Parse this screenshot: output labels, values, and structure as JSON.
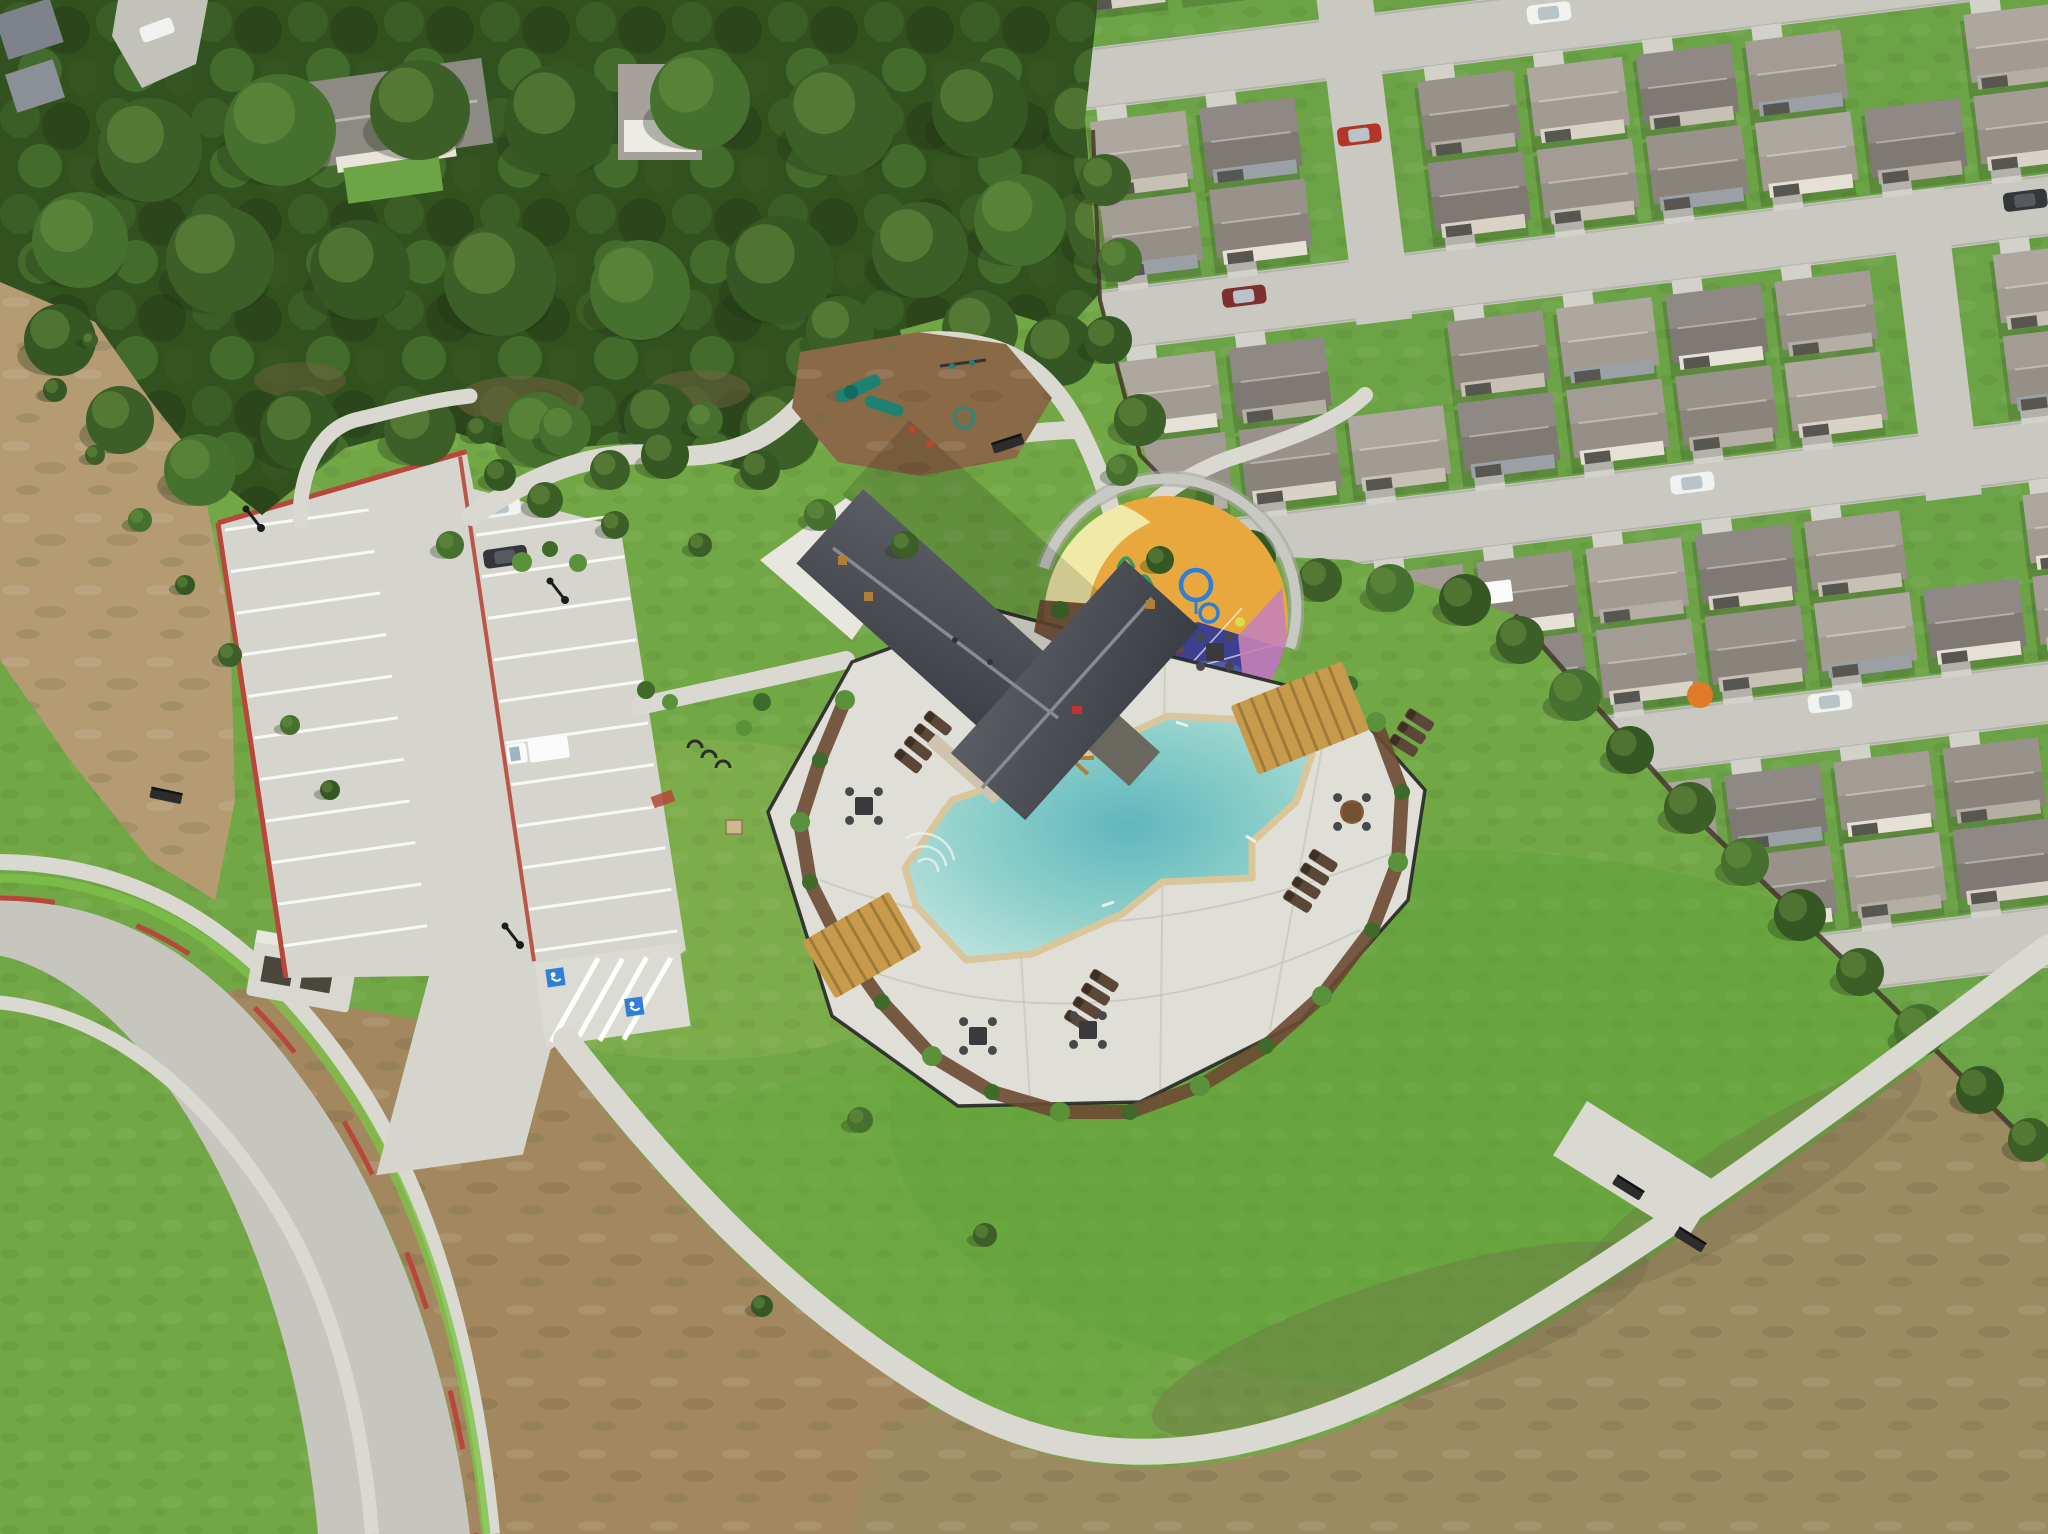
{
  "scene": {
    "description": "Aerial drone photo of a new residential community amenity center: cross-gabled clubhouse, angular swimming pool with white deck and black fence, colorful circular splash pad, playground in pine forest, parking lot with red curbs, winding sidewalks, suburban rooftops upper right, bare dirt lots lower left and lower right",
    "colors": {
      "lawn": "#72a746",
      "lawn_bright": "#5da335",
      "lawn_shadow": "#4e8a2f",
      "forest_base": "#31511f",
      "tree_shadow": "#1d3314",
      "tree_light": "#6f9a44",
      "dirt_left": "#b49b72",
      "dirt_bottom": "#a3885f",
      "dirt_slope": "#9c8a60",
      "dirt_streak": "#6f6b49",
      "concrete": "#d6d5cd",
      "concrete_bright": "#e7e6df",
      "path": "#dad9d1",
      "road": "#c6c5be",
      "curb_red": "#b8463b",
      "sod_bright": "#7cc247",
      "deck": "#e0dfd7",
      "deck_line": "#c6c5bd",
      "pool_coping": "#d9c69b",
      "pool_edge": "#bfe4de",
      "pool_mid": "#8fd0cb",
      "pool_deep": "#5fb7bd",
      "fence": "#262626",
      "fence_wood": "#44362a",
      "mulch": "#6b4a33",
      "shrub_dark": "#3f6b2a",
      "shrub_light": "#59923a",
      "roof_dark": "#4b4f55",
      "roof_dark2": "#3a3e44",
      "roof_ridge": "#878b91",
      "stone": "#cfc5ae",
      "wood": "#b07f3a",
      "pergola": "#c79b4b",
      "splash_yellow": "#f1e9a8",
      "splash_amber": "#e9a83d",
      "splash_indigo": "#3d3f8f",
      "splash_indigo_light": "#5d68b5",
      "splash_pink": "#c581b6",
      "spray_blue": "#2f7fd6",
      "spray_green": "#2f9a67",
      "splash_wall": "#c9c9c4",
      "playground_mulch": "#8a6a46",
      "play_teal": "#1d8274",
      "street": "#c9c8c1",
      "driveway": "#d2d1ca",
      "car_white": "#f2f2f0",
      "car_silver": "#c6c8ca",
      "car_dark": "#33363a",
      "car_red": "#b33527",
      "car_maroon": "#7e2f2f",
      "car_truck": "#fafafa",
      "lamp": "#1d1d1d",
      "bench": "#2c2c2c",
      "umbrella_orange": "#e07a28",
      "cooler_red": "#c23434",
      "ball_yellow": "#d6e04a",
      "house_roofs": [
        "#968f87",
        "#8a837c",
        "#a29b92",
        "#7f7973"
      ],
      "house_walls": [
        "#d9d3c7",
        "#c7c1b5",
        "#9aa0a5",
        "#e6e1d6",
        "#b4aea4"
      ],
      "garage": "#585650",
      "tree_greens": [
        "#3c5f27",
        "#46702e",
        "#355724"
      ]
    },
    "neighborhood": {
      "streets": [
        {
          "y": 40
        },
        {
          "y": 282
        },
        {
          "y": 524
        },
        {
          "y": 766
        },
        {
          "y": 1008
        }
      ],
      "street_h": 62,
      "cross_streets": [
        {
          "x": 248,
          "y1": -80,
          "y2": 348
        },
        {
          "x": 792,
          "y1": 282,
          "y2": 592
        }
      ],
      "grid": {
        "cols": [
          8,
          118,
          228,
          338,
          448,
          558,
          668,
          778,
          888,
          998
        ],
        "w": 96,
        "h": 78,
        "rows": [
          {
            "y": -72,
            "drive": "none",
            "len": 0
          },
          {
            "y": 114,
            "drive": "up",
            "len": 14
          },
          {
            "y": 196,
            "drive": "down",
            "len": 10
          },
          {
            "y": 356,
            "drive": "up",
            "len": 14
          },
          {
            "y": 438,
            "drive": "down",
            "len": 10
          },
          {
            "y": 598,
            "drive": "up",
            "len": 14
          },
          {
            "y": 680,
            "drive": "down",
            "len": 10
          },
          {
            "y": 840,
            "drive": "up",
            "len": 14
          },
          {
            "y": 922,
            "drive": "down",
            "len": 10
          }
        ],
        "skips": {
          "0": [
            2
          ],
          "1": [
            2,
            7
          ],
          "2": [
            2
          ],
          "3": [
            2,
            7
          ],
          "4": [
            7
          ],
          "5": [
            7
          ],
          "6": [
            1
          ],
          "7": [
            0,
            1
          ],
          "8": [
            0,
            1,
            2,
            3
          ]
        }
      },
      "street_cars": [
        {
          "x": 455,
          "y": 52,
          "t": "car",
          "c": "car_white"
        },
        {
          "x": 700,
          "y": 48,
          "t": "car",
          "c": "car_silver"
        },
        {
          "x": 118,
          "y": 296,
          "t": "car",
          "c": "car_maroon"
        },
        {
          "x": 252,
          "y": 150,
          "t": "car",
          "c": "car_red"
        },
        {
          "x": 540,
          "y": 536,
          "t": "car",
          "c": "car_white"
        },
        {
          "x": 905,
          "y": 296,
          "t": "car",
          "c": "car_dark"
        },
        {
          "x": 355,
          "y": 772,
          "t": "car",
          "c": "car_silver"
        },
        {
          "x": 650,
          "y": 770,
          "t": "car",
          "c": "car_white"
        },
        {
          "x": 308,
          "y": 620,
          "t": "truck",
          "c": "car_truck"
        }
      ]
    },
    "parking": {
      "stripe_count_left": 10,
      "stripe_count_right": 10,
      "cars": [
        {
          "x": 252,
          "y": 6,
          "t": "car",
          "c": "car_white"
        },
        {
          "x": 252,
          "y": 56,
          "t": "car",
          "c": "car_dark"
        },
        {
          "x": 248,
          "y": 252,
          "t": "truck",
          "c": "car_truck"
        }
      ]
    },
    "trees": {
      "forest": [
        [
          150,
          150,
          52,
          0
        ],
        [
          280,
          130,
          56,
          1
        ],
        [
          420,
          110,
          50,
          0
        ],
        [
          560,
          120,
          56,
          2
        ],
        [
          700,
          100,
          50,
          1
        ],
        [
          840,
          120,
          56,
          0
        ],
        [
          980,
          110,
          48,
          2
        ],
        [
          80,
          240,
          48,
          1
        ],
        [
          220,
          260,
          54,
          0
        ],
        [
          360,
          270,
          50,
          2
        ],
        [
          500,
          280,
          56,
          0
        ],
        [
          640,
          290,
          50,
          1
        ],
        [
          780,
          270,
          54,
          2
        ],
        [
          920,
          250,
          48,
          0
        ],
        [
          1020,
          220,
          46,
          1
        ],
        [
          1086,
          120,
          38,
          2
        ],
        [
          1108,
          230,
          40,
          0
        ],
        [
          60,
          340,
          36,
          2
        ],
        [
          120,
          420,
          34,
          0
        ],
        [
          200,
          470,
          36,
          1
        ],
        [
          300,
          430,
          40,
          2
        ],
        [
          420,
          430,
          36,
          0
        ],
        [
          540,
          430,
          38,
          1
        ],
        [
          660,
          420,
          36,
          2
        ],
        [
          780,
          430,
          40,
          0
        ],
        [
          880,
          380,
          36,
          1
        ],
        [
          980,
          330,
          38,
          0
        ],
        [
          1060,
          350,
          36,
          2
        ],
        [
          945,
          415,
          30,
          1
        ],
        [
          840,
          330,
          34,
          0
        ]
      ],
      "treeline": [
        [
          1105,
          180,
          26,
          0
        ],
        [
          1120,
          260,
          22,
          1
        ],
        [
          1108,
          340,
          24,
          2
        ],
        [
          1140,
          420,
          26,
          0
        ],
        [
          1190,
          500,
          24,
          1
        ],
        [
          1250,
          556,
          26,
          2
        ],
        [
          1320,
          580,
          22,
          0
        ],
        [
          1390,
          588,
          24,
          1
        ],
        [
          1465,
          600,
          26,
          2
        ],
        [
          1520,
          640,
          24,
          0
        ],
        [
          1575,
          695,
          26,
          1
        ],
        [
          1630,
          750,
          24,
          2
        ],
        [
          1690,
          808,
          26,
          0
        ],
        [
          1745,
          862,
          24,
          1
        ],
        [
          1800,
          915,
          26,
          2
        ],
        [
          1860,
          972,
          24,
          0
        ],
        [
          1920,
          1030,
          26,
          1
        ],
        [
          1980,
          1090,
          24,
          2
        ],
        [
          2030,
          1140,
          22,
          0
        ]
      ],
      "lawn": [
        [
          565,
          430,
          26,
          1
        ],
        [
          610,
          470,
          20,
          0
        ],
        [
          665,
          455,
          24,
          2
        ],
        [
          705,
          420,
          18,
          1
        ],
        [
          545,
          500,
          18,
          0
        ],
        [
          500,
          475,
          16,
          2
        ],
        [
          450,
          545,
          14,
          1
        ],
        [
          615,
          525,
          14,
          0
        ],
        [
          760,
          470,
          20,
          2
        ],
        [
          820,
          515,
          16,
          1
        ],
        [
          700,
          545,
          12,
          0
        ],
        [
          480,
          430,
          14,
          2
        ],
        [
          860,
          1120,
          13,
          1
        ],
        [
          985,
          1235,
          12,
          0
        ],
        [
          762,
          1306,
          11,
          2
        ],
        [
          905,
          545,
          14,
          0
        ],
        [
          1122,
          470,
          16,
          1
        ],
        [
          1160,
          560,
          14,
          2
        ]
      ],
      "dirt": [
        [
          55,
          390,
          12,
          2
        ],
        [
          95,
          455,
          10,
          0
        ],
        [
          140,
          520,
          12,
          1
        ],
        [
          185,
          585,
          10,
          2
        ],
        [
          230,
          655,
          12,
          0
        ],
        [
          290,
          725,
          10,
          1
        ],
        [
          330,
          790,
          10,
          2
        ],
        [
          90,
          340,
          8,
          0
        ]
      ]
    },
    "shrubs": [
      [
        845,
        700,
        10
      ],
      [
        820,
        760,
        8
      ],
      [
        800,
        822,
        10
      ],
      [
        810,
        882,
        8
      ],
      [
        842,
        946,
        10
      ],
      [
        882,
        1002,
        8
      ],
      [
        932,
        1056,
        10
      ],
      [
        992,
        1092,
        8
      ],
      [
        1060,
        1112,
        10
      ],
      [
        1130,
        1112,
        8
      ],
      [
        1200,
        1086,
        10
      ],
      [
        1266,
        1046,
        8
      ],
      [
        1322,
        996,
        10
      ],
      [
        1372,
        930,
        8
      ],
      [
        1398,
        862,
        10
      ],
      [
        1402,
        792,
        8
      ],
      [
        1376,
        722,
        10
      ],
      [
        1350,
        684,
        8
      ],
      [
        522,
        562,
        10
      ],
      [
        550,
        549,
        8
      ],
      [
        578,
        563,
        9
      ],
      [
        646,
        690,
        9
      ],
      [
        670,
        702,
        8
      ],
      [
        762,
        702,
        9
      ],
      [
        744,
        728,
        8
      ],
      [
        1060,
        610,
        9
      ],
      [
        1100,
        622,
        8
      ],
      [
        1140,
        636,
        9
      ]
    ],
    "furniture": {
      "lounger_groups": [
        {
          "x": 893,
          "y": 756,
          "rot": -52,
          "n": 4,
          "dx": 16
        },
        {
          "x": 1063,
          "y": 1018,
          "rot": -58,
          "n": 4,
          "dx": 16
        },
        {
          "x": 1282,
          "y": 898,
          "rot": -58,
          "n": 4,
          "dx": 16
        },
        {
          "x": 1388,
          "y": 742,
          "rot": -58,
          "n": 3,
          "dx": 15
        }
      ],
      "tables": [
        {
          "x": 864,
          "y": 806,
          "u": 0
        },
        {
          "x": 978,
          "y": 1036,
          "u": 0
        },
        {
          "x": 1088,
          "y": 1030,
          "u": 0
        },
        {
          "x": 1215,
          "y": 652,
          "u": 0
        },
        {
          "x": 1352,
          "y": 812,
          "u": 1
        }
      ],
      "benches": [
        {
          "x": 1628,
          "y": 1188,
          "rot": 32
        },
        {
          "x": 1690,
          "y": 1240,
          "rot": 32
        },
        {
          "x": 1008,
          "y": 444,
          "rot": -18
        },
        {
          "x": 166,
          "y": 796,
          "rot": 12
        }
      ],
      "lamps": [
        [
          261,
          528
        ],
        [
          565,
          600
        ],
        [
          520,
          945
        ]
      ]
    }
  }
}
